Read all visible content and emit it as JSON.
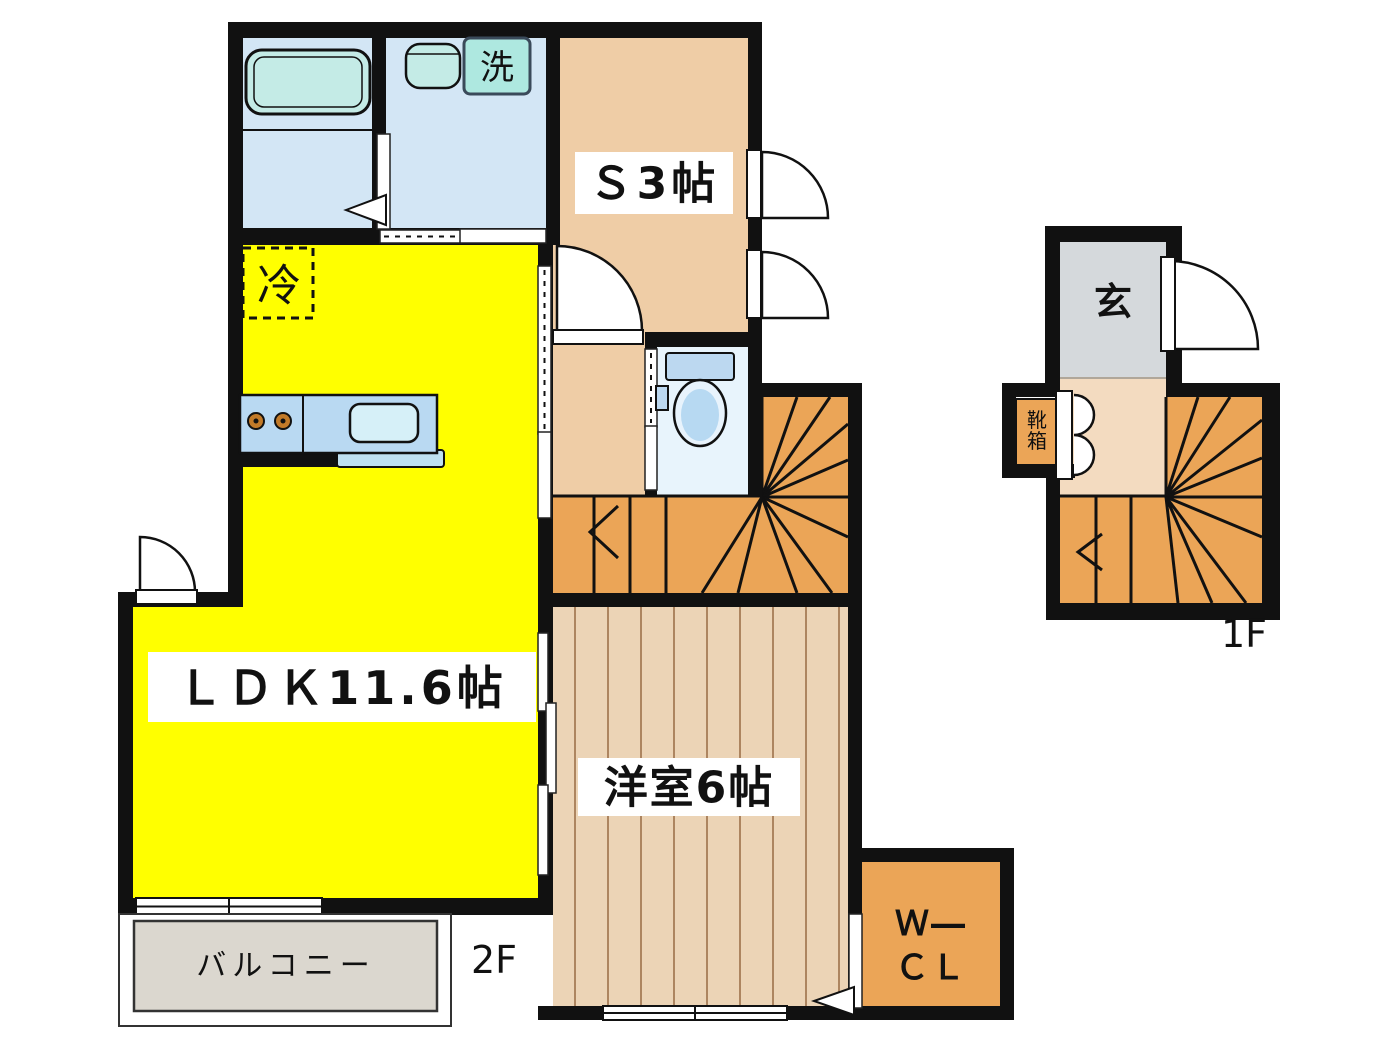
{
  "title": "floor-plan",
  "floor2": {
    "label": "2F",
    "rooms": {
      "ldk": "ＬＤＫ11.6帖",
      "storage": "Ｓ3帖",
      "western": "洋室6帖",
      "balcony": "バルコニー",
      "wcl_line1": "Ｗ―",
      "wcl_line2": "ＣＬ"
    },
    "fixtures": {
      "fridge": "冷",
      "washer": "洗"
    }
  },
  "floor1": {
    "label": "1F",
    "rooms": {
      "entrance": "玄",
      "shoe_box": "靴箱"
    }
  },
  "colors": {
    "ldk_yellow": "#ffff00",
    "room_tan": "#efcda6",
    "wood_floor": "#ecd4b6",
    "stair_orange": "#eba557",
    "water_blue": "#d3e6f5",
    "tub_teal": "#c4ebe6",
    "washer_teal": "#aee8e0",
    "entrance_gray": "#d5d9dc",
    "balcony_gray": "#dbd7cf",
    "wall_black": "#111111"
  }
}
